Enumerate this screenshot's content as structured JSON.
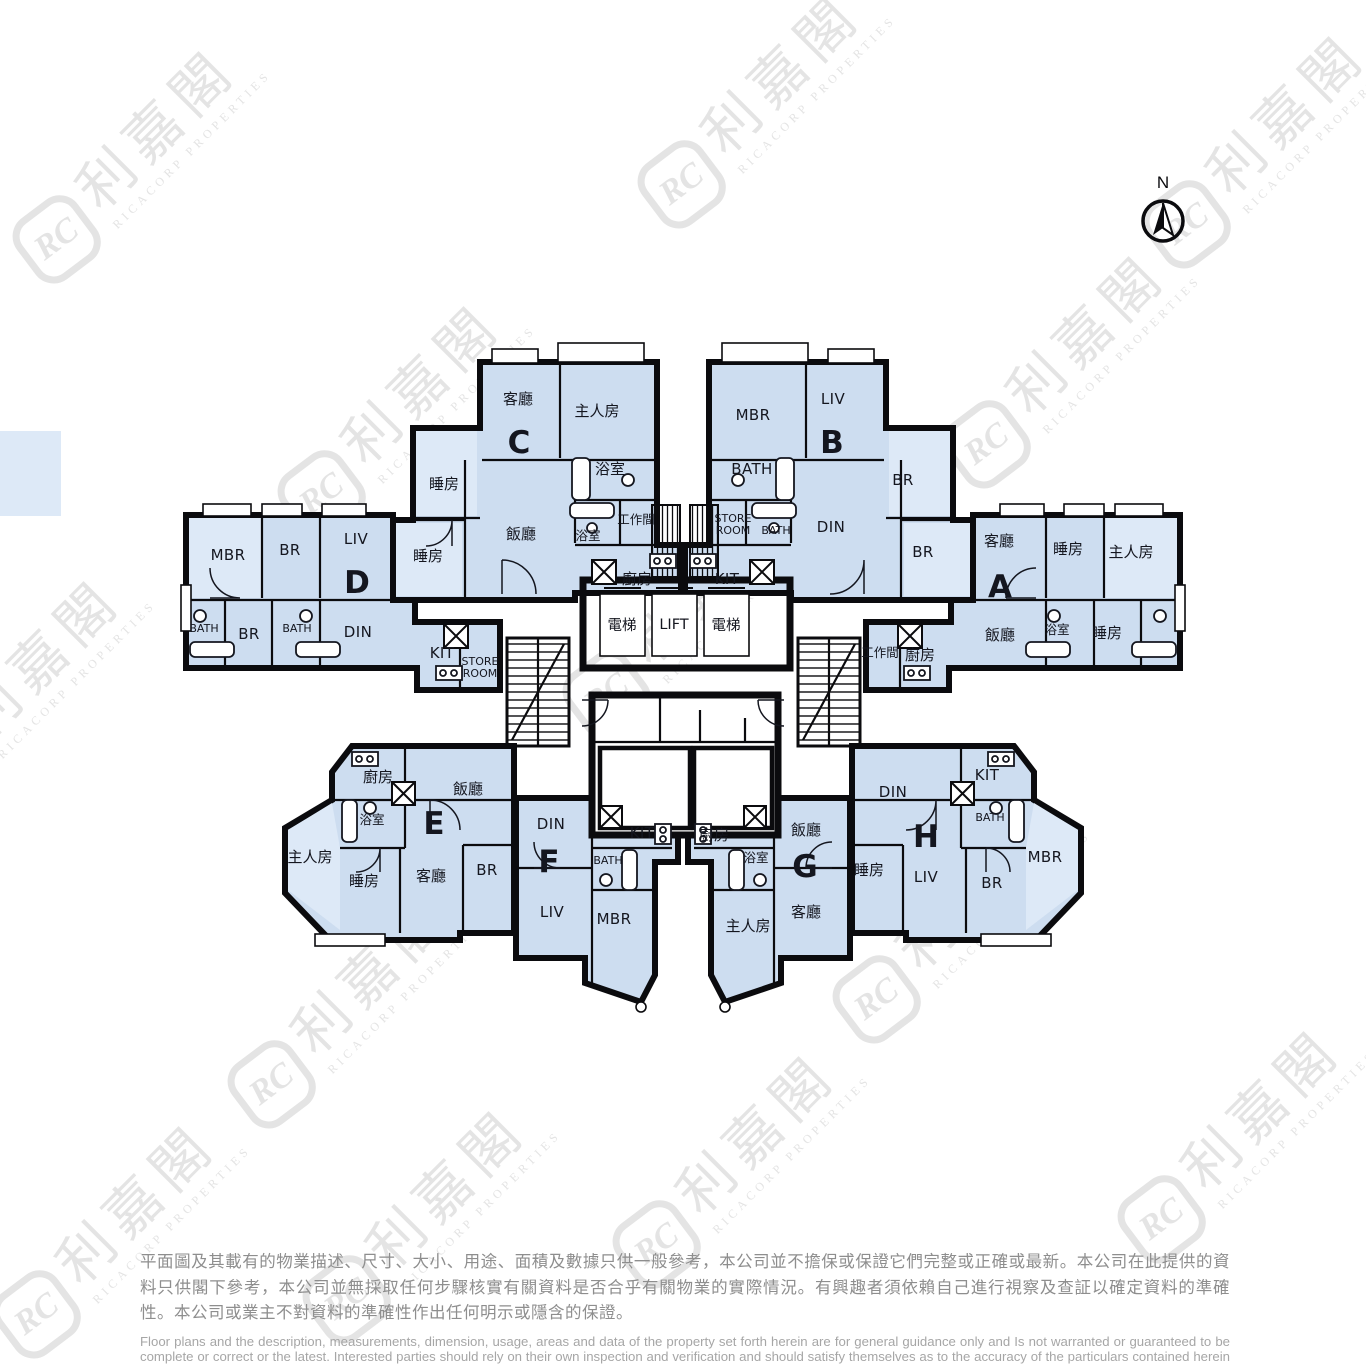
{
  "brand": {
    "logo_monogram": "RC",
    "name_zh": "利嘉閣",
    "name_en": "RICACORP PROPERTIES"
  },
  "compass": {
    "label": "N"
  },
  "core": {
    "lift_left": "電梯",
    "lift_center": "LIFT",
    "lift_right": "電梯"
  },
  "units": {
    "c": {
      "letter": "C",
      "living": "客廳",
      "master": "主人房",
      "bath1": "浴室",
      "bath2": "浴室",
      "utility": "工作間",
      "dining": "飯廳",
      "bed1": "睡房",
      "bed2": "睡房",
      "kitchen": "廚房"
    },
    "b": {
      "letter": "B",
      "mbr": "MBR",
      "liv": "LIV",
      "bath1": "BATH",
      "bath2": "BATH",
      "store1": "STORE",
      "store2": "ROOM",
      "din": "DIN",
      "br1": "BR",
      "br2": "BR",
      "kit": "KIT"
    },
    "d": {
      "letter": "D",
      "mbr": "MBR",
      "br1": "BR",
      "liv": "LIV",
      "bath1": "BATH",
      "br2": "BR",
      "bath2": "BATH",
      "din": "DIN",
      "kit": "KIT",
      "store1": "STORE",
      "store2": "ROOM"
    },
    "a": {
      "letter": "A",
      "living": "客廳",
      "bed1": "睡房",
      "master": "主人房",
      "dining": "飯廳",
      "bath": "浴室",
      "bed2": "睡房",
      "utility": "工作間",
      "kitchen": "廚房"
    },
    "e": {
      "letter": "E",
      "kitchen": "廚房",
      "dining": "飯廳",
      "bath": "浴室",
      "master": "主人房",
      "bed": "睡房",
      "living": "客廳",
      "br": "BR"
    },
    "f": {
      "letter": "F",
      "din": "DIN",
      "kit": "KIT",
      "bath": "BATH",
      "liv": "LIV",
      "mbr": "MBR"
    },
    "g": {
      "letter": "G",
      "kitchen": "廚房",
      "bath": "浴室",
      "dining": "飯廳",
      "living": "客廳",
      "master": "主人房"
    },
    "h": {
      "letter": "H",
      "din": "DIN",
      "kit": "KIT",
      "bath": "BATH",
      "bed": "睡房",
      "liv": "LIV",
      "br": "BR",
      "mbr": "MBR"
    }
  },
  "disclaimer": {
    "zh": "平面圖及其載有的物業描述、尺寸、大小、用途、面積及數據只供一般參考，本公司並不擔保或保證它們完整或正確或最新。本公司在此提供的資料只供閣下參考，本公司並無採取任何步驟核實有關資料是否合乎有關物業的實際情況。有興趣者須依賴自己進行視察及查証以確定資料的準確性。本公司或業主不對資料的準確性作出任何明示或隱含的保證。",
    "en": "Floor plans and the description, measurements, dimension, usage, areas and data of the property set forth herein are for general guidance only and Is not warranted or guaranteed to be complete or correct or the latest. Interested parties should rely on their own inspection and verification and should satisfy themselves as to the accuracy of the particulars contained herein which are provided by us for information only.  Our Company has not taken any step to verify whether the information reflects the actual status of the property.  No warranty for accuracy is given or implied by the owners or us."
  }
}
